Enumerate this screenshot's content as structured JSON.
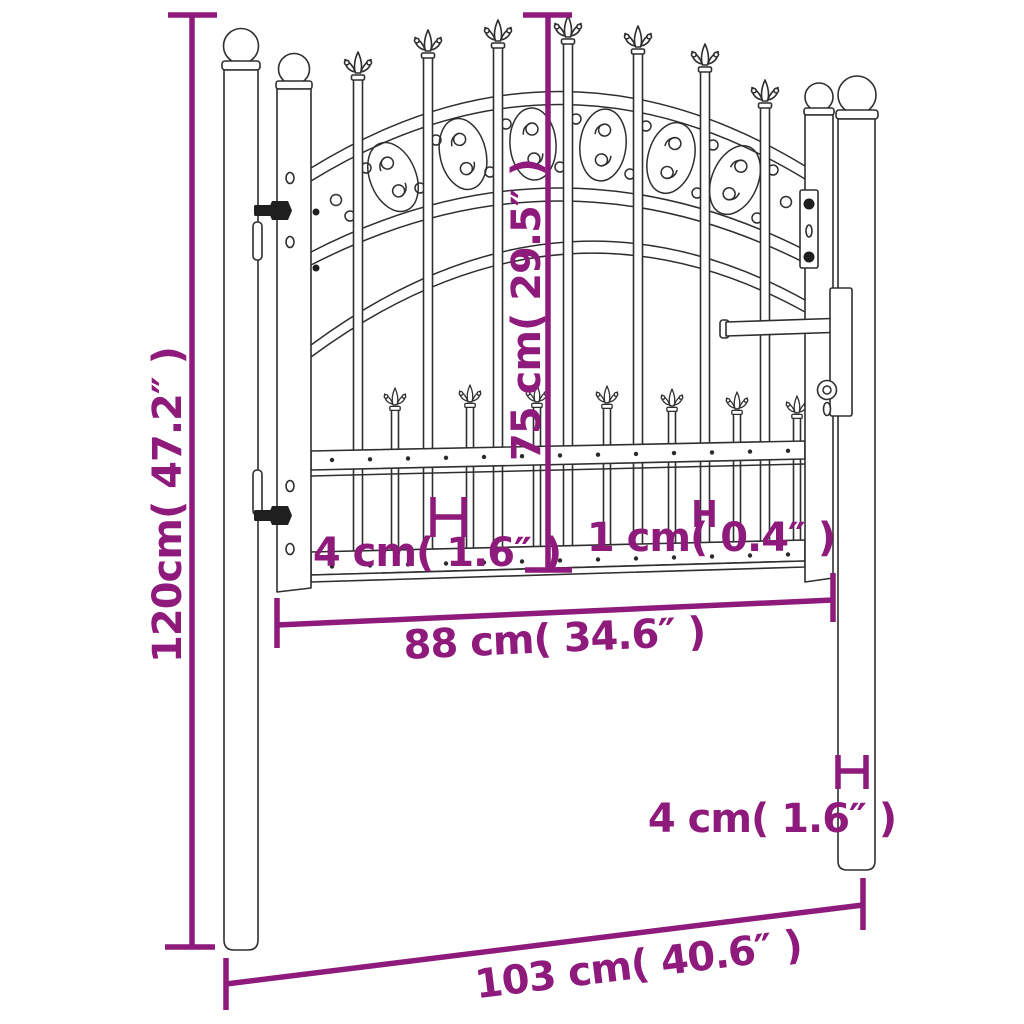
{
  "page": {
    "type": "product-dimension-diagram",
    "subject": "steel garden gate with spear top, scrollwork arch and two round posts",
    "background_color": "#ffffff",
    "drawing_color": "#2f2f2f",
    "dimension_color": "#8e1a7c"
  },
  "dimensions": {
    "total_height": "120cm( 47.2″ )",
    "gate_height": "75 cm( 29.5″ )",
    "picket_spacing": "4 cm( 1.6″ )",
    "bar_thickness": "1 cm( 0.4″ )",
    "gate_width": "88 cm( 34.6″ )",
    "post_thickness": "4 cm( 1.6″ )",
    "total_width": "103 cm( 40.6″ )"
  }
}
